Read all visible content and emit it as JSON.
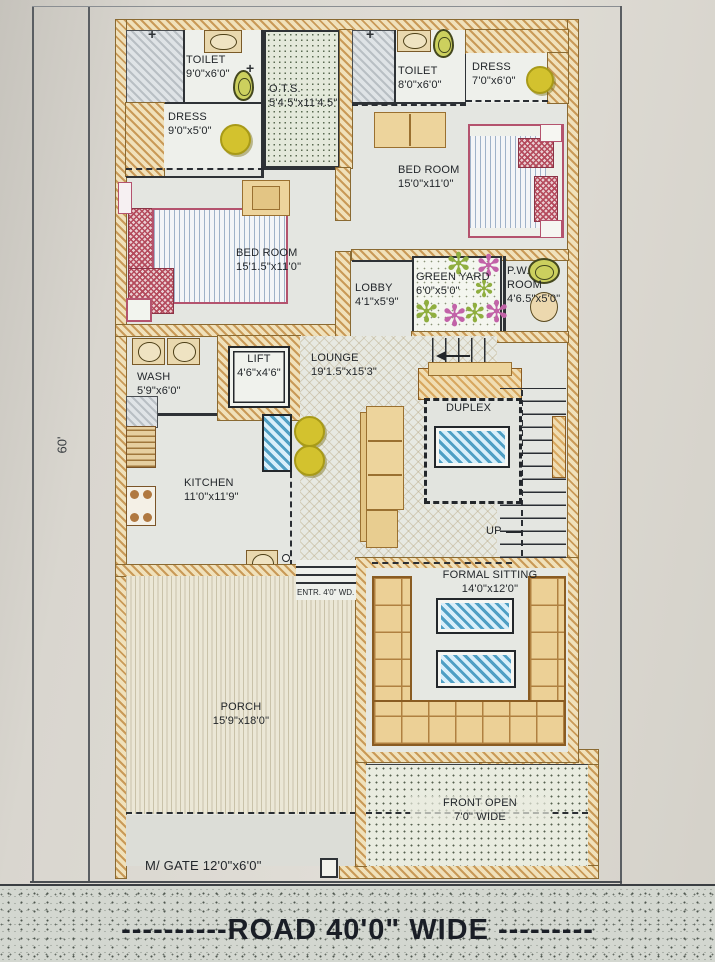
{
  "labels": {
    "dimension_left": "60'",
    "road": "----------ROAD 40'0\" WIDE ---------",
    "gate": "M/ GATE 12'0\"x6'0\"",
    "entrance": "ENTR. 4'0\" WD.",
    "up": "UP"
  },
  "rooms": {
    "toilet_1": {
      "name": "TOILET",
      "size": "9'0\"x6'0\""
    },
    "ots": {
      "name": "O.T.S.",
      "size": "5'4.5\"x11'4.5\""
    },
    "toilet_2": {
      "name": "TOILET",
      "size": "8'0\"x6'0\""
    },
    "dress_2": {
      "name": "DRESS",
      "size": "7'0\"x6'0\""
    },
    "dress_1": {
      "name": "DRESS",
      "size": "9'0\"x5'0\""
    },
    "bedroom_2": {
      "name": "BED ROOM",
      "size": "15'0\"x11'0\""
    },
    "bedroom_1": {
      "name": "BED ROOM",
      "size": "15'1.5\"x11'0\""
    },
    "lobby": {
      "name": "LOBBY",
      "size": "4'1\"x5'9\""
    },
    "green_yard": {
      "name": "GREEN YARD",
      "size": "6'0\"x5'0\""
    },
    "pw_room": {
      "name": "P.W. ROOM",
      "size": "4'6.5\"x5'0\""
    },
    "wash": {
      "name": "WASH",
      "size": "5'9\"x6'0\""
    },
    "lift": {
      "name": "LIFT",
      "size": "4'6\"x4'6\""
    },
    "lounge": {
      "name": "LOUNGE",
      "size": "19'1.5\"x15'3\""
    },
    "duplex": {
      "name": "DUPLEX",
      "size": ""
    },
    "kitchen": {
      "name": "KITCHEN",
      "size": "11'0\"x11'9\""
    },
    "formal_sitting": {
      "name": "FORMAL SITTING",
      "size": "14'0\"x12'0\""
    },
    "porch": {
      "name": "PORCH",
      "size": "15'9\"x18'0\""
    },
    "front_open": {
      "name": "FRONT OPEN",
      "size": "7'0\" WIDE"
    }
  },
  "colors": {
    "wall_tan": "#e7d7ae",
    "floor": "#e4e6e1",
    "table_blue": "#4f9fc4",
    "stool_yellow": "#d3c22e",
    "flower_green": "#8fae3f",
    "flower_pink": "#c263a8",
    "bed_outline_pink": "#b4536e",
    "road_grey": "#d3d7d0"
  }
}
